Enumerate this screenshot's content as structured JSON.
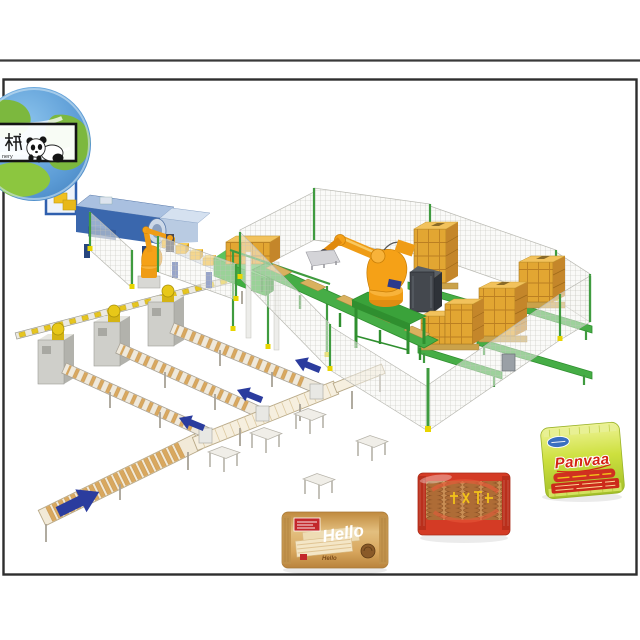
{
  "canvas": {
    "width": 640,
    "height": 640,
    "background": "#ffffff",
    "frame_color": "#2e2e2e"
  },
  "logo": {
    "machine_char": "械",
    "partial_word": "nery",
    "globe_icon": "globe-earth-icon",
    "panda_icon": "panda-icon",
    "colors": {
      "ocean": "#5b9bd5",
      "land": "#7cb83e",
      "box_border": "#141414"
    }
  },
  "scene": {
    "title": "automated-biscuit-packing-line-illustration",
    "elements": [
      "blue-wrapping-machine",
      "pick-robot",
      "case-packer",
      "palletizer-robot",
      "control-cabinet",
      "safety-fence",
      "pallet-stacks",
      "pallet-conveyor",
      "flow-wrapper-machines",
      "infeed-rail",
      "product-conveyors",
      "collector-conveyor",
      "support-tables"
    ],
    "flow_arrow_color": "#2b3c9e",
    "flow_arrows": {
      "small_count": 3,
      "small_direction": "up-left toward wrappers",
      "large_count": 1,
      "large_direction": "up-right"
    },
    "machine_colors": {
      "robot_orange": "#f5a117",
      "conveyor_green": "#3aa23a",
      "box_orange": "#e2a632",
      "machine_blue": "#3a67ad",
      "wrapper_gray": "#c9c9c4",
      "fence_post_green": "#3f9b3f",
      "fence_foot_yellow": "#e8d500",
      "biscuit_tan": "#d9a85f",
      "reel_yellow": "#e8c818"
    },
    "counts": {
      "wrapper_machines": 3,
      "pallet_stacks": 5,
      "robots": 2
    }
  },
  "packages": {
    "hello": {
      "brand": "Hello",
      "body_color": "#d8a75e",
      "label_color": "#c3272b",
      "text_color": "#ffffff"
    },
    "red_biscuit": {
      "brand": "",
      "body_color": "#d43b25",
      "accent_text_color": "#f2c21a"
    },
    "panvaa": {
      "brand": "Panvaa",
      "brand_color": "#d42313",
      "body_color": "#cde03e",
      "banner_color": "#d03020",
      "oval_color": "#3a6fc0"
    }
  }
}
